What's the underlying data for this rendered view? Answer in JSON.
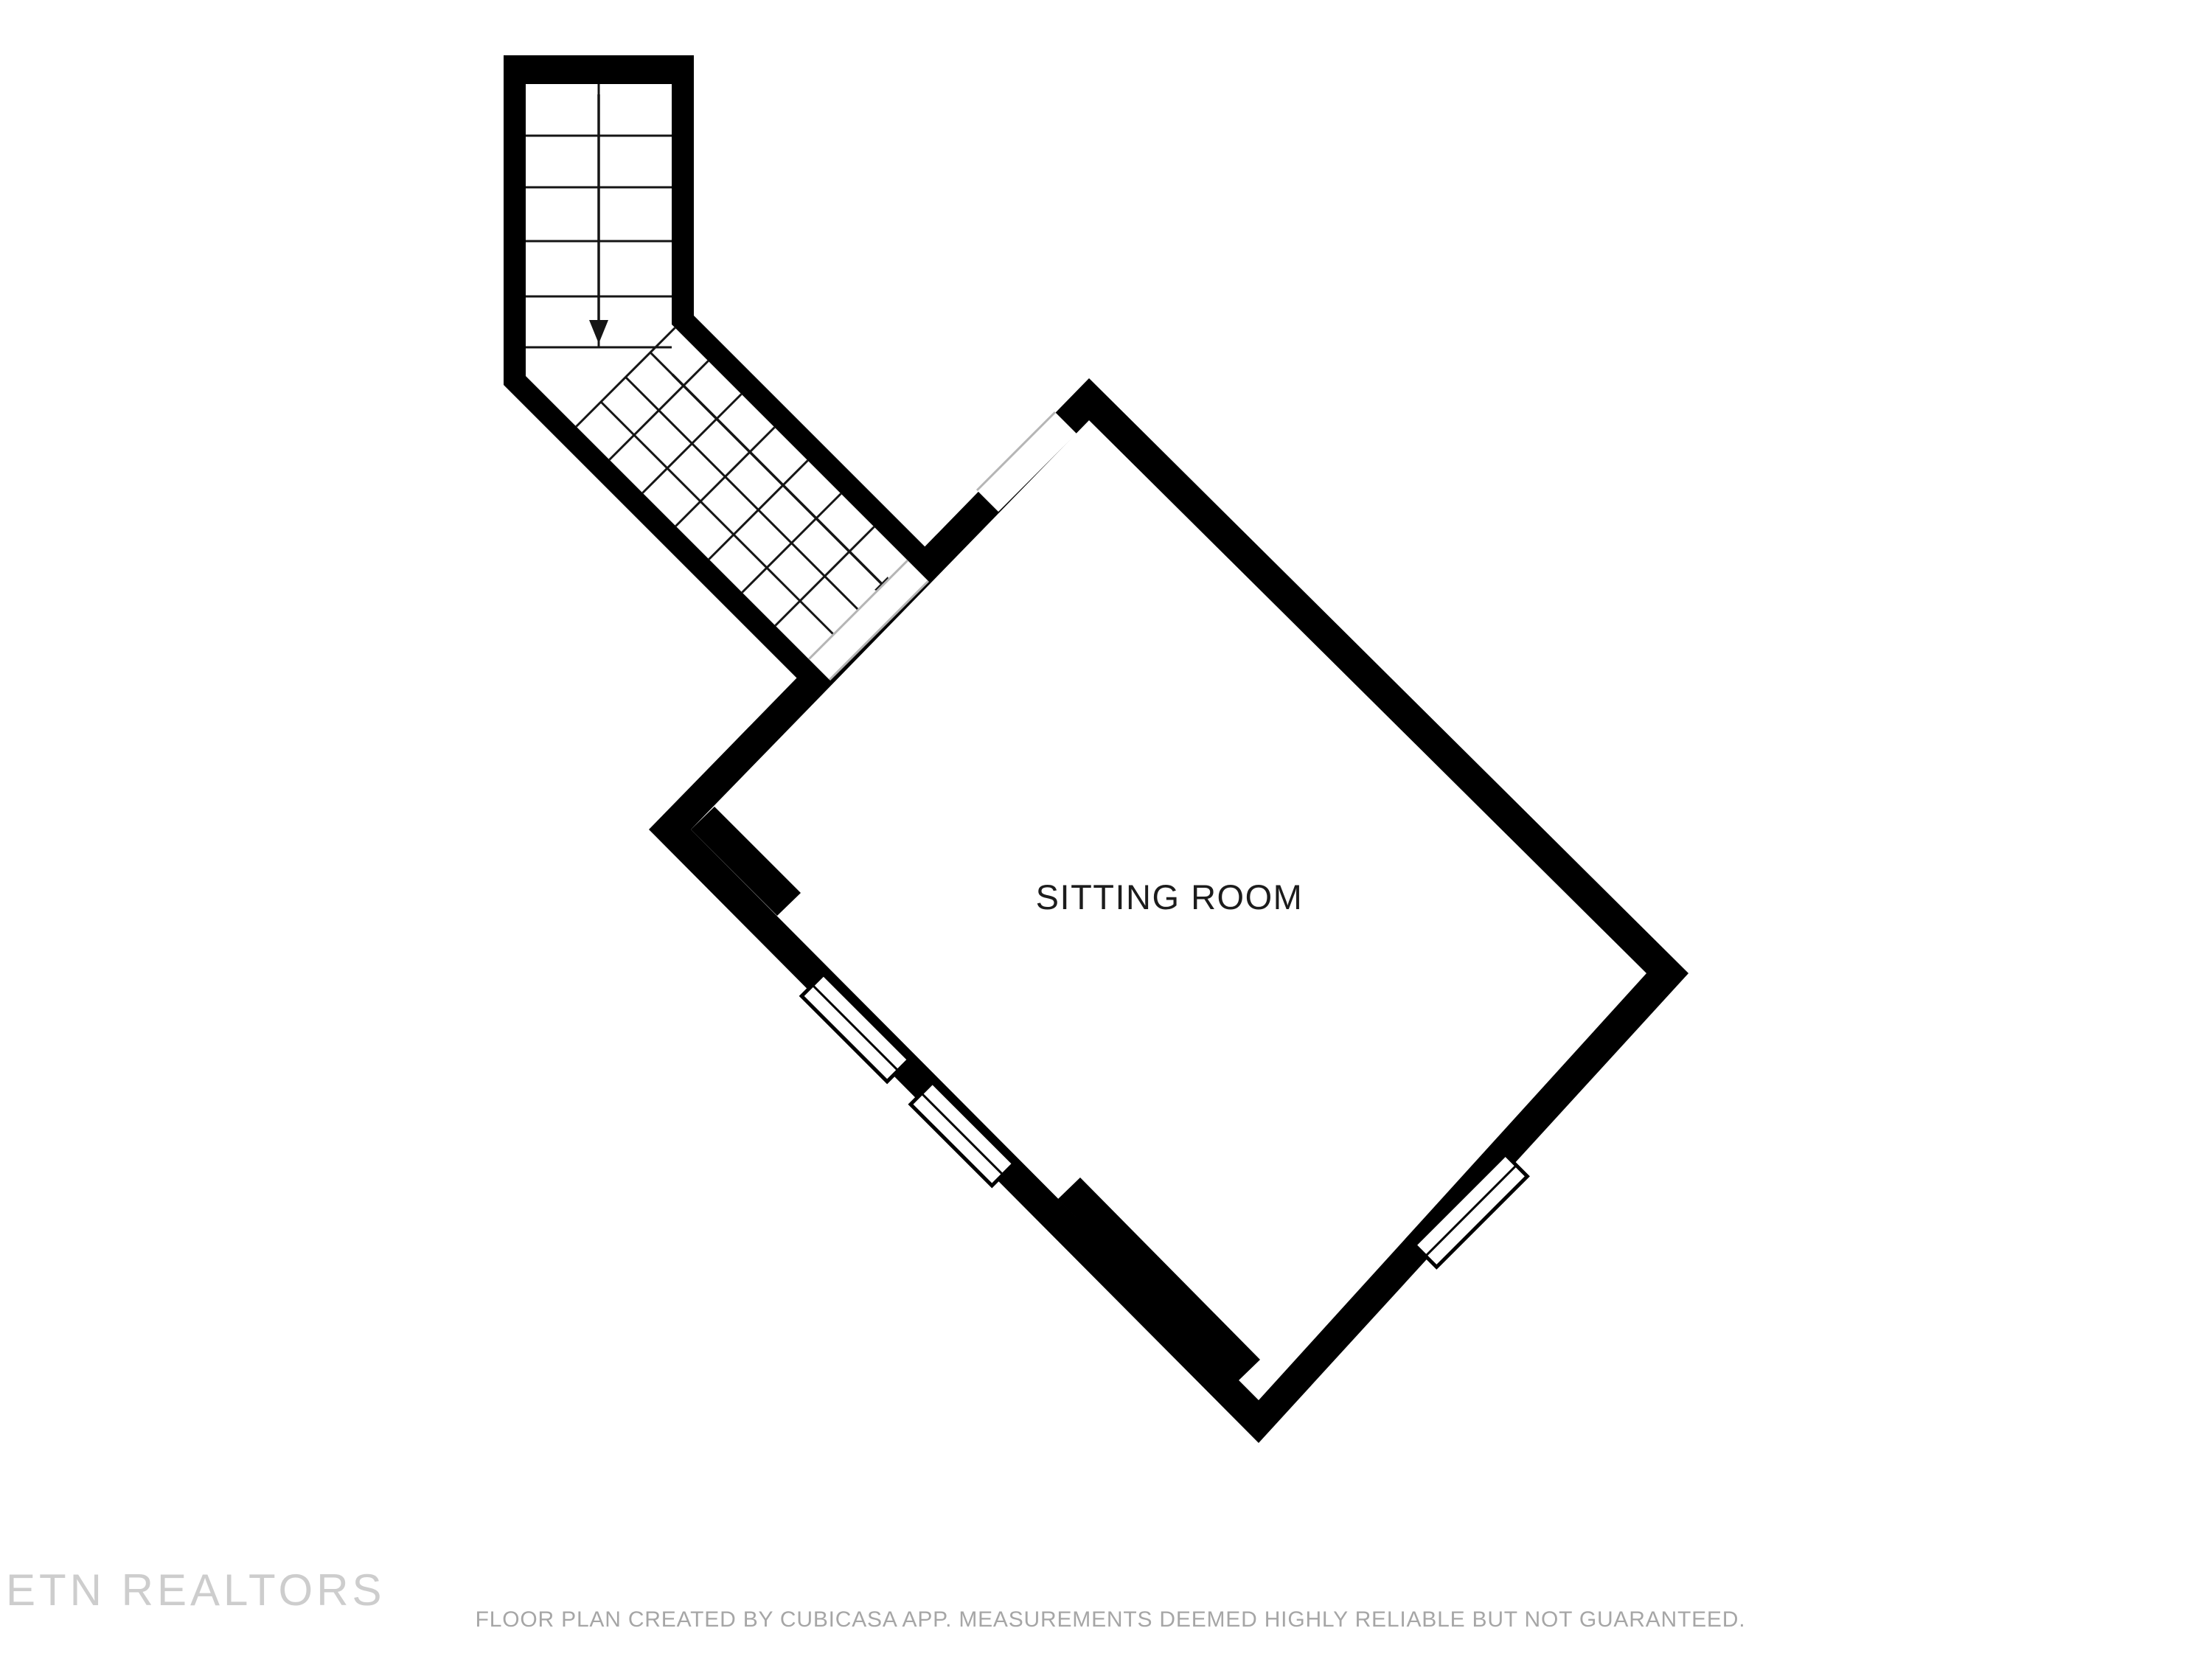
{
  "floor_plan": {
    "room_label": "SITTING ROOM",
    "watermark": "ETN REALTORS",
    "disclaimer": "FLOOR PLAN CREATED BY CUBICASA APP. MEASUREMENTS DEEMED HIGHLY RELIABLE BUT NOT GUARANTEED.",
    "stairs": {
      "direction_arrows": 2,
      "straight_flight_treads": 5,
      "diagonal_flight_treads": 7
    },
    "colors": {
      "wall": "#000000",
      "background": "#ffffff",
      "stair_line": "#151515",
      "opening_line": "#b5b5b5",
      "label_text": "#1c1c1c",
      "watermark_text": "#cdcdcd",
      "disclaimer_text": "#a6a6a6"
    }
  }
}
